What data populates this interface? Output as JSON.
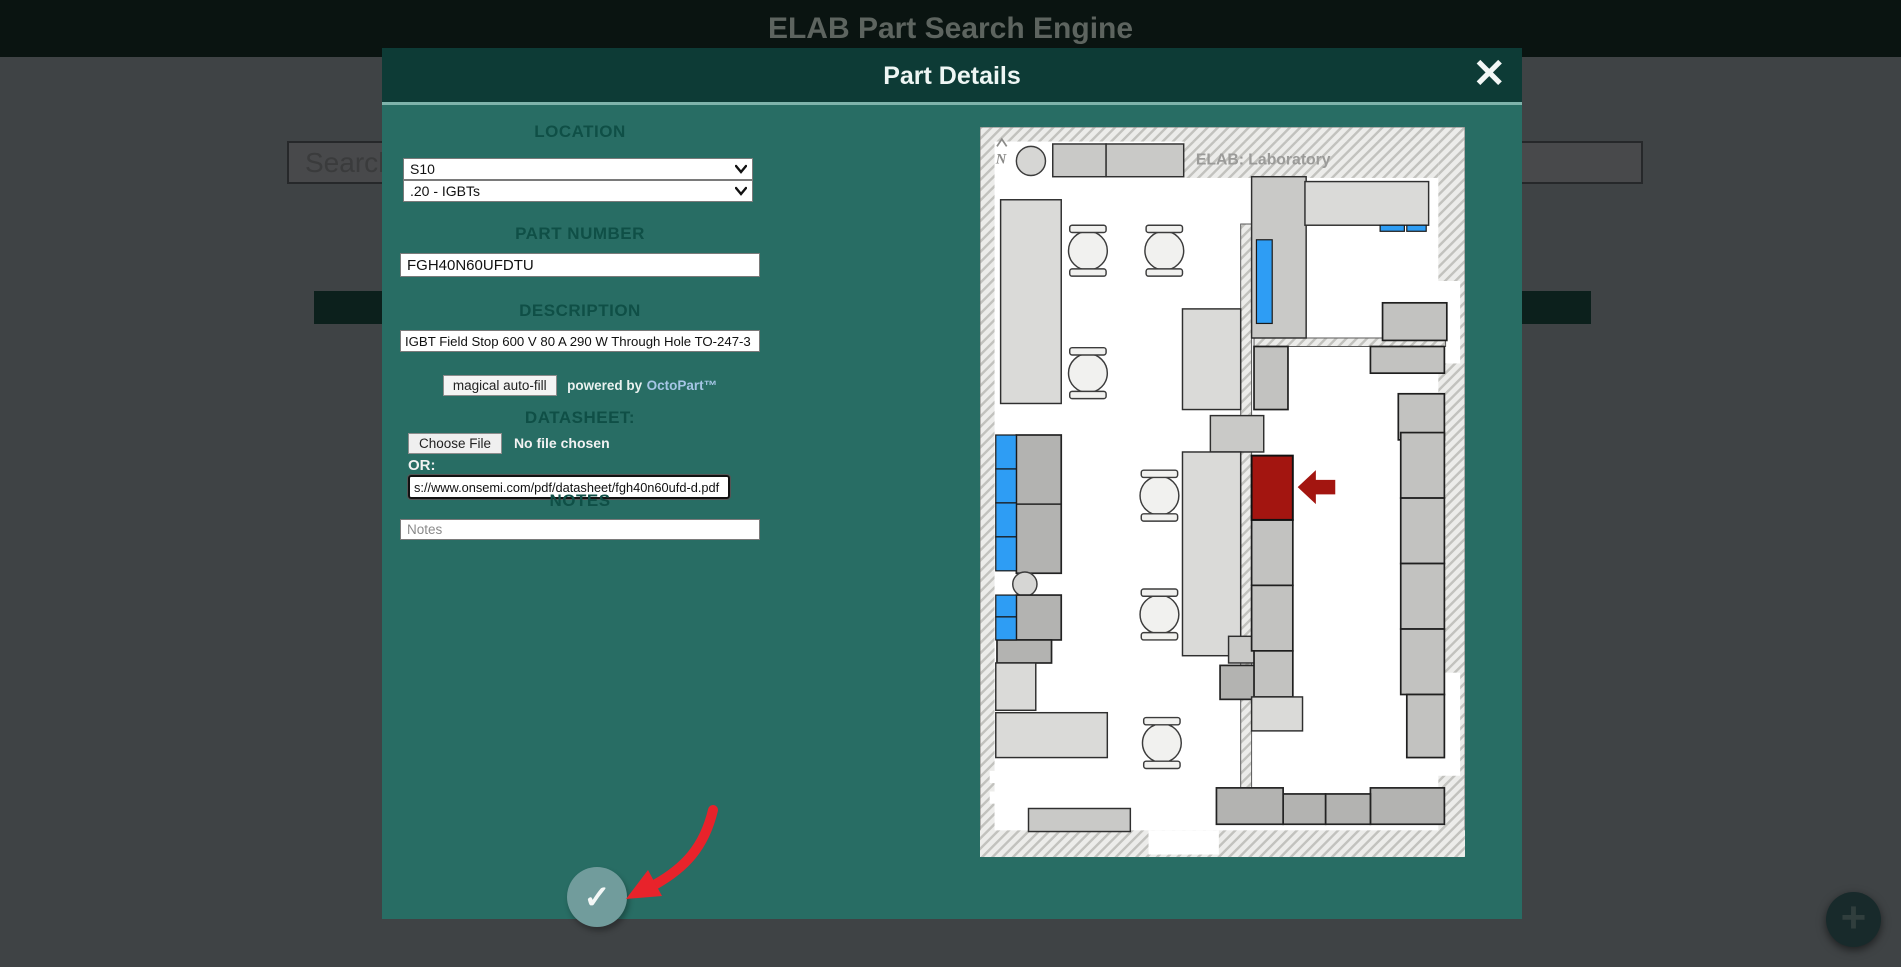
{
  "page": {
    "title": "ELAB Part Search Engine",
    "search_value": "Search",
    "add_button": "+"
  },
  "modal": {
    "title": "Part Details",
    "close_icon": "✕",
    "fields": {
      "location_label": "LOCATION",
      "location_shelf": "S10",
      "location_bin": ".20 - IGBTs",
      "part_number_label": "PART NUMBER",
      "part_number_value": "FGH40N60UFDTU",
      "description_label": "DESCRIPTION",
      "description_value": "IGBT Field Stop 600 V 80 A 290 W Through Hole TO-247-3",
      "autofill_button": "magical auto-fill",
      "powered_by": "powered by",
      "octopart": "OctoPart™",
      "datasheet_label": "DATASHEET:",
      "choose_file": "Choose File",
      "no_file": "No file chosen",
      "or_label": "OR:",
      "datasheet_url": "s://www.onsemi.com/pdf/datasheet/fgh40n60ufd-d.pdf",
      "notes_label": "NOTES",
      "notes_placeholder": "Notes",
      "submit_icon": "✓"
    }
  },
  "map": {
    "title": "ELAB: Laboratory",
    "compass": "N",
    "colors": {
      "available_highlight": "#2e9df4",
      "selected_highlight": "#a31510",
      "annotation_red": "#e8232b"
    }
  }
}
